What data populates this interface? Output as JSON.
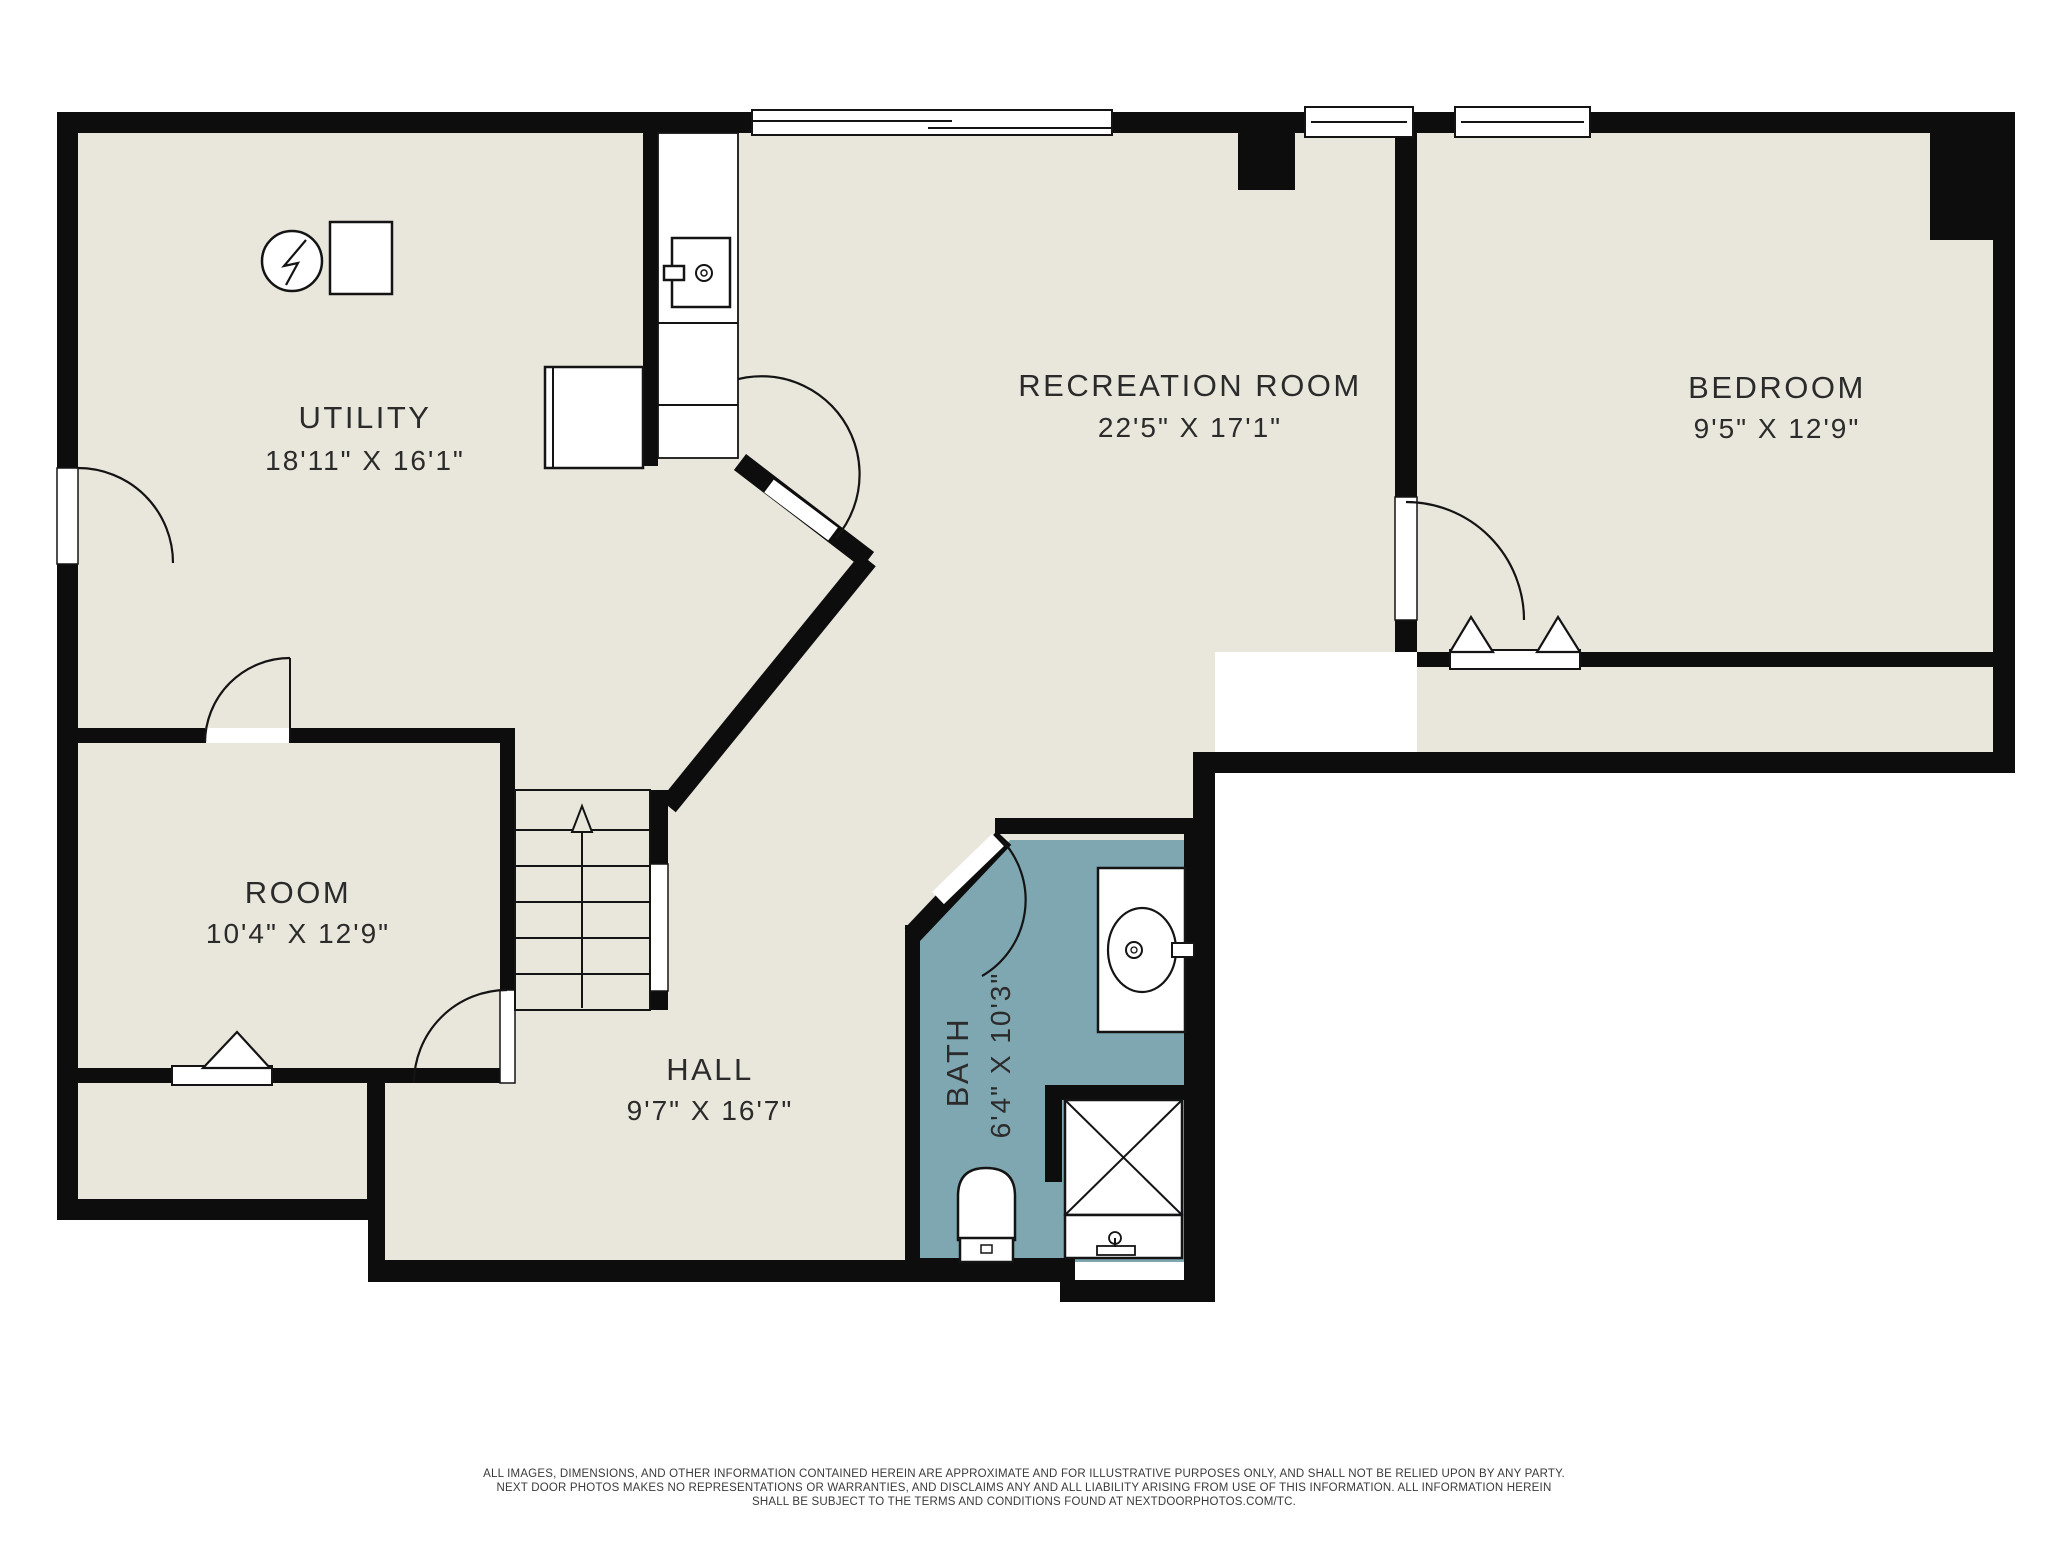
{
  "colors": {
    "wall": "#0d0d0d",
    "floor": "#e9e7dc",
    "bath_floor": "#7ea7b2",
    "text": "#2b2b2b",
    "disclaimer_text": "#3a3a3a",
    "background": "#ffffff"
  },
  "rooms": [
    {
      "id": "utility",
      "name": "UTILITY",
      "dims": "18'11\" X 16'1\""
    },
    {
      "id": "recreation",
      "name": "RECREATION ROOM",
      "dims": "22'5\" X 17'1\""
    },
    {
      "id": "bedroom",
      "name": "BEDROOM",
      "dims": "9'5\" X 12'9\""
    },
    {
      "id": "room",
      "name": "ROOM",
      "dims": "10'4\" X 12'9\""
    },
    {
      "id": "hall",
      "name": "HALL",
      "dims": "9'7\" X 16'7\""
    },
    {
      "id": "bath",
      "name": "BATH",
      "dims": "6'4\" X 10'3\""
    }
  ],
  "disclaimer": {
    "line1": "ALL IMAGES, DIMENSIONS, AND OTHER INFORMATION CONTAINED HEREIN ARE APPROXIMATE AND FOR ILLUSTRATIVE PURPOSES ONLY, AND SHALL NOT BE RELIED UPON BY ANY PARTY.",
    "line2": "NEXT DOOR PHOTOS MAKES NO REPRESENTATIONS OR WARRANTIES, AND DISCLAIMS ANY AND ALL LIABILITY ARISING FROM USE OF THIS INFORMATION. ALL INFORMATION HEREIN",
    "line3": "SHALL BE SUBJECT TO THE TERMS AND CONDITIONS FOUND AT NEXTDOORPHOTOS.COM/TC."
  }
}
